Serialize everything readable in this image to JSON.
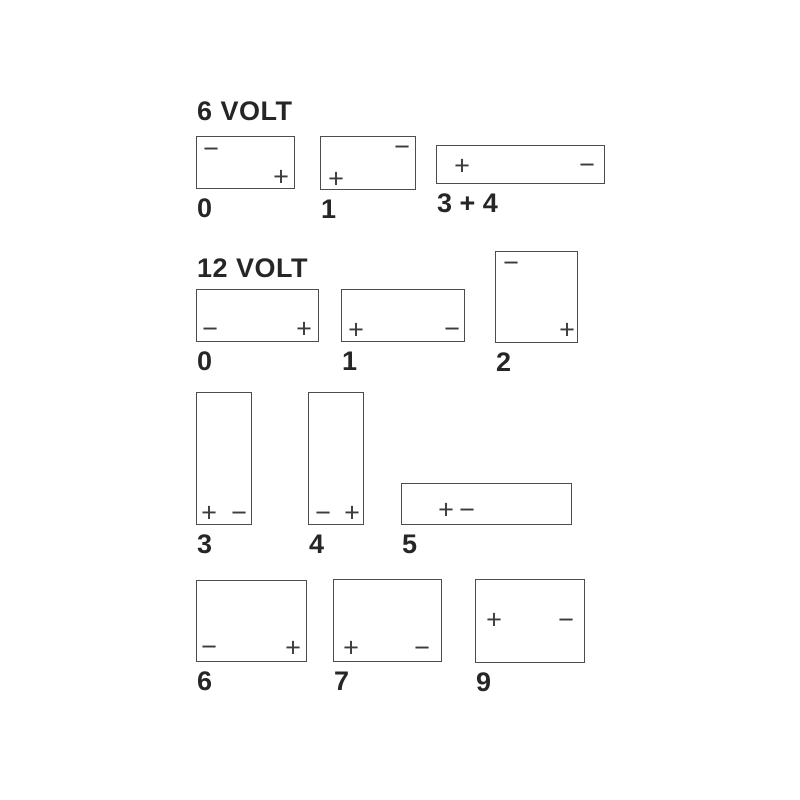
{
  "page": {
    "background": "#ffffff",
    "line_color": "#4c4c4c",
    "text_color": "#262626",
    "terminal_color": "#3c3c3c"
  },
  "sections": [
    {
      "heading": "6 VOLT",
      "heading_pos": {
        "x": 197,
        "y": 98
      },
      "batteries": [
        {
          "label": "0",
          "box": {
            "x": 196,
            "y": 136,
            "w": 99,
            "h": 53
          },
          "terminals": [
            {
              "sign": "−",
              "name": "minus-terminal",
              "x": 14,
              "y": 12
            },
            {
              "sign": "+",
              "name": "plus-terminal",
              "x": 84,
              "y": 40
            }
          ]
        },
        {
          "label": "1",
          "box": {
            "x": 320,
            "y": 136,
            "w": 96,
            "h": 54
          },
          "terminals": [
            {
              "sign": "−",
              "name": "minus-terminal",
              "x": 81,
              "y": 10
            },
            {
              "sign": "+",
              "name": "plus-terminal",
              "x": 15,
              "y": 42
            }
          ]
        },
        {
          "label": "3 + 4",
          "box": {
            "x": 436,
            "y": 145,
            "w": 169,
            "h": 39
          },
          "terminals": [
            {
              "sign": "+",
              "name": "plus-terminal",
              "x": 25,
              "y": 20
            },
            {
              "sign": "−",
              "name": "minus-terminal",
              "x": 150,
              "y": 19
            }
          ]
        }
      ]
    },
    {
      "heading": "12 VOLT",
      "heading_pos": {
        "x": 197,
        "y": 255
      },
      "batteries": [
        {
          "label": "0",
          "box": {
            "x": 196,
            "y": 289,
            "w": 123,
            "h": 53
          },
          "terminals": [
            {
              "sign": "−",
              "name": "minus-terminal",
              "x": 13,
              "y": 39
            },
            {
              "sign": "+",
              "name": "plus-terminal",
              "x": 107,
              "y": 39
            }
          ]
        },
        {
          "label": "1",
          "box": {
            "x": 341,
            "y": 289,
            "w": 124,
            "h": 53
          },
          "terminals": [
            {
              "sign": "+",
              "name": "plus-terminal",
              "x": 14,
              "y": 40
            },
            {
              "sign": "−",
              "name": "minus-terminal",
              "x": 110,
              "y": 39
            }
          ]
        },
        {
          "label": "2",
          "box": {
            "x": 495,
            "y": 251,
            "w": 83,
            "h": 92
          },
          "terminals": [
            {
              "sign": "−",
              "name": "minus-terminal",
              "x": 15,
              "y": 11
            },
            {
              "sign": "+",
              "name": "plus-terminal",
              "x": 71,
              "y": 78
            }
          ]
        },
        {
          "label": "3",
          "box": {
            "x": 196,
            "y": 392,
            "w": 56,
            "h": 133
          },
          "terminals": [
            {
              "sign": "+",
              "name": "plus-terminal",
              "x": 12,
              "y": 120
            },
            {
              "sign": "−",
              "name": "minus-terminal",
              "x": 42,
              "y": 120
            }
          ]
        },
        {
          "label": "4",
          "box": {
            "x": 308,
            "y": 392,
            "w": 56,
            "h": 133
          },
          "terminals": [
            {
              "sign": "−",
              "name": "minus-terminal",
              "x": 14,
              "y": 120
            },
            {
              "sign": "+",
              "name": "plus-terminal",
              "x": 43,
              "y": 120
            }
          ]
        },
        {
          "label": "5",
          "box": {
            "x": 401,
            "y": 483,
            "w": 171,
            "h": 42
          },
          "terminals": [
            {
              "sign": "+",
              "name": "plus-terminal",
              "x": 44,
              "y": 26
            },
            {
              "sign": "−",
              "name": "minus-terminal",
              "x": 65,
              "y": 26
            }
          ]
        },
        {
          "label": "6",
          "box": {
            "x": 196,
            "y": 580,
            "w": 111,
            "h": 82
          },
          "terminals": [
            {
              "sign": "−",
              "name": "minus-terminal",
              "x": 12,
              "y": 66
            },
            {
              "sign": "+",
              "name": "plus-terminal",
              "x": 96,
              "y": 67
            }
          ]
        },
        {
          "label": "7",
          "box": {
            "x": 333,
            "y": 579,
            "w": 109,
            "h": 83
          },
          "terminals": [
            {
              "sign": "+",
              "name": "plus-terminal",
              "x": 17,
              "y": 68
            },
            {
              "sign": "−",
              "name": "minus-terminal",
              "x": 88,
              "y": 68
            }
          ]
        },
        {
          "label": "9",
          "box": {
            "x": 475,
            "y": 579,
            "w": 110,
            "h": 84
          },
          "terminals": [
            {
              "sign": "+",
              "name": "plus-terminal",
              "x": 18,
              "y": 40
            },
            {
              "sign": "−",
              "name": "minus-terminal",
              "x": 90,
              "y": 40
            }
          ]
        }
      ]
    }
  ]
}
